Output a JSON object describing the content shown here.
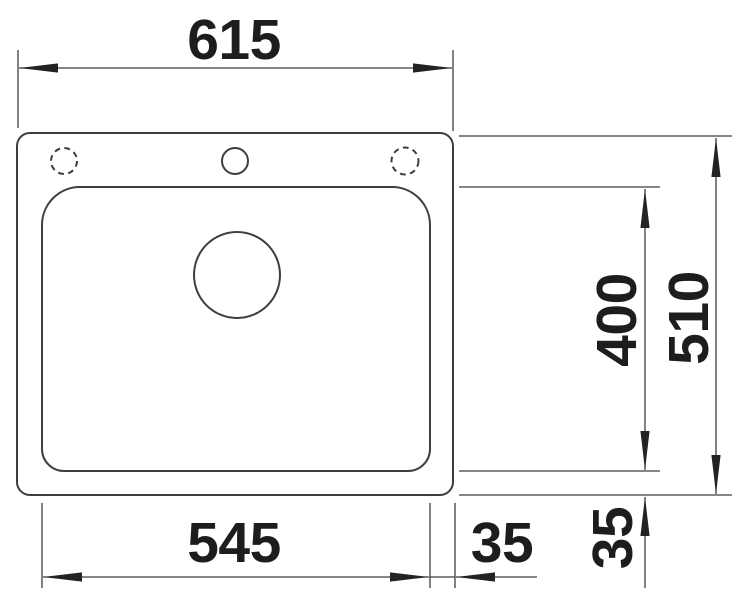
{
  "diagram": {
    "kind": "sink-top-view-dimension-drawing",
    "labels": {
      "overall_width": "615",
      "overall_depth": "510",
      "bowl_width": "545",
      "bowl_depth": "400",
      "rim_right": "35",
      "rim_bottom": "35"
    },
    "colors": {
      "background": "#ffffff",
      "line": "#3e3e3e",
      "arrow": "#232323",
      "text": "#1d1d1b"
    }
  }
}
